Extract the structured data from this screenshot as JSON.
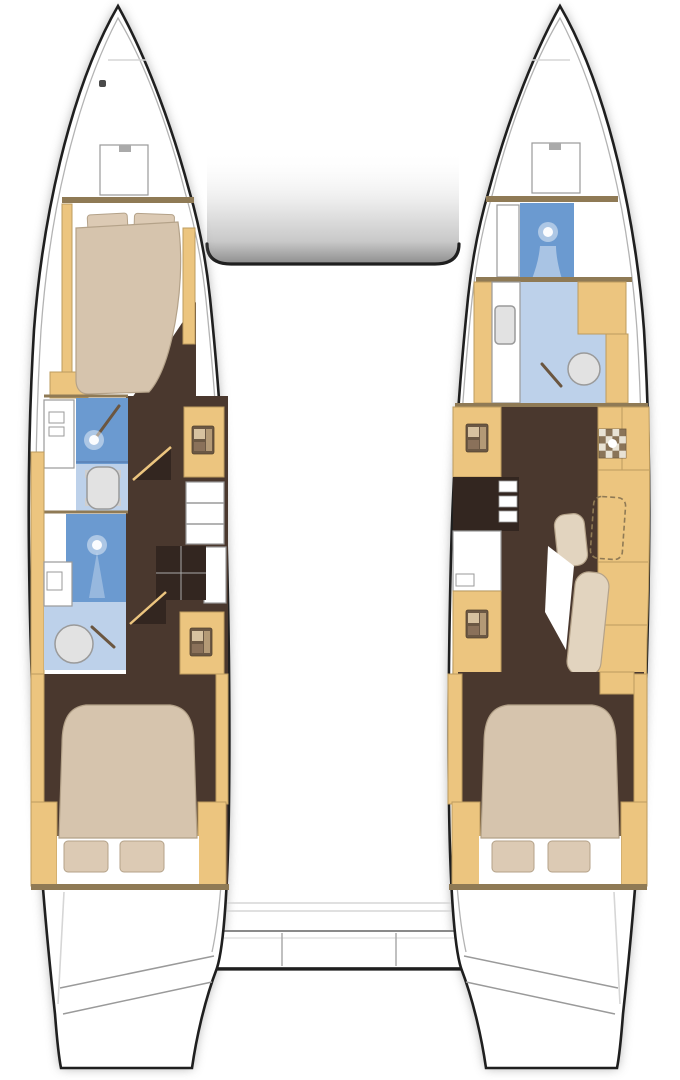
{
  "diagram": {
    "kind": "catamaran-interior-floor-plan",
    "hulls": {
      "port": {
        "rooms": [
          "forepeak",
          "forward-cabin",
          "forward-head-shower",
          "forward-head-toilet",
          "aft-head-shower",
          "aft-head-basin",
          "companionway",
          "aft-cabin",
          "transom-steps"
        ]
      },
      "starboard": {
        "rooms": [
          "forepeak",
          "forward-shower",
          "forward-head-basin",
          "cabinet-units",
          "desk-seating",
          "companionway",
          "aft-cabin",
          "transom-steps"
        ]
      }
    },
    "cockpit": [
      "bench-seat",
      "aft-platform"
    ]
  },
  "labels": {
    "plan": "Catamaran interior layout plan",
    "port_hull": "Port hull",
    "starboard_hull": "Starboard hull",
    "port_forward_cabin": "Port forward cabin with double berth",
    "port_aft_cabin": "Port aft cabin with double berth",
    "starboard_aft_cabin": "Starboard aft cabin with double berth",
    "port_forward_head": "Port forward head with shower and toilet",
    "port_aft_head": "Port aft head with shower and basin",
    "starboard_forward_head": "Starboard forward head with shower and basin",
    "cockpit_bench": "Aft cockpit bench seat",
    "aft_platform": "Aft platform between hulls"
  },
  "colors": {
    "outline": "#1f1f1f",
    "line": "#9a9a9a",
    "faint": "#d6d6d6",
    "shadow": "#8e8e8e",
    "wood": "#ecc57f",
    "wood_edge": "#bd9c5f",
    "wall": "#8f7a55",
    "floor": "#4a382e",
    "floor_dark": "#332620",
    "bed": "#d6c4ad",
    "bed_soft": "#e2d4bf",
    "bed_edge": "#b4a289",
    "pillow": "#dccab4",
    "shower": "#6b9ad0",
    "shower_pan_edge": "#5d86bb",
    "bath": "#bdd1ea",
    "bath_soft": "#a9c4e4",
    "fixture": "#e2e2e2",
    "fixture_edge": "#9a9a9a",
    "hose": "#6b5640",
    "icon_dark": "#6b5844",
    "icon_light": "#d7c2a0"
  },
  "icons": [
    "deck-hatch-icon",
    "shower-head-icon",
    "toilet-icon",
    "wash-basin-icon",
    "faucet-icon",
    "sink-unit-icon",
    "hob-icon",
    "companionway-steps-icon",
    "steps-arrow-icon",
    "transom-steps-icon"
  ]
}
